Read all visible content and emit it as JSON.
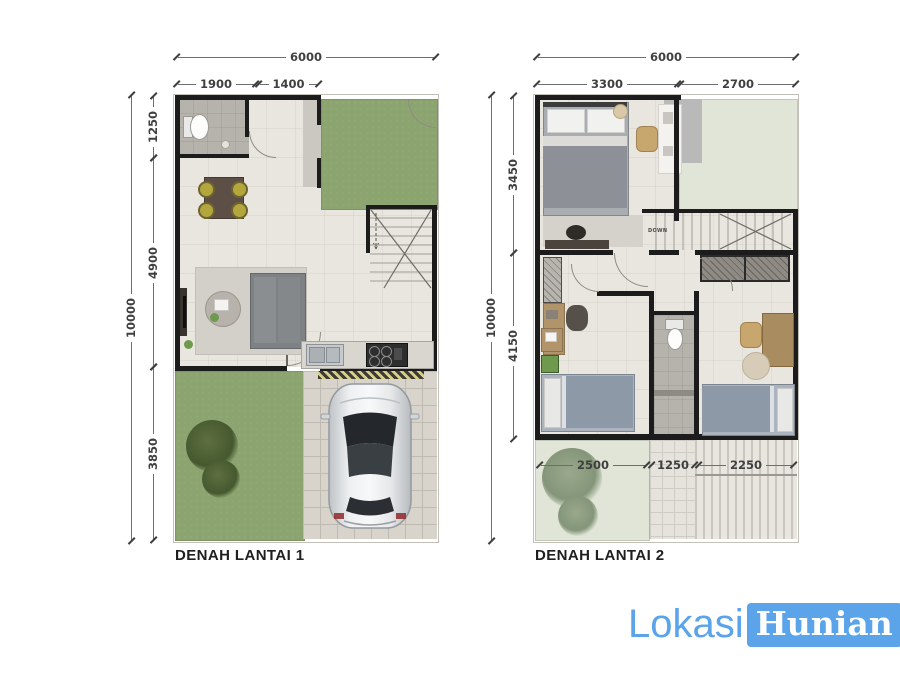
{
  "colors": {
    "wall": "#1c1c1c",
    "floor": "#e9e5df",
    "bath-floor": "#b6b2ac",
    "garden": "#8ca46f",
    "terrace": "#e0e5d7",
    "dim": "#3f3f3f",
    "label": "#1f1f1f",
    "site-border": "#c3bfb9",
    "logo-blue": "#5ba4ea"
  },
  "plan1": {
    "title": "DENAH LANTAI 1",
    "dims": {
      "width_total": "6000",
      "width_segments": [
        "1900",
        "1400"
      ],
      "height_total": "10000",
      "height_segments": [
        "1250",
        "4900",
        "3850"
      ]
    }
  },
  "plan2": {
    "title": "DENAH LANTAI 2",
    "dims": {
      "width_total": "6000",
      "width_segments": [
        "3300",
        "2700"
      ],
      "height_total": "10000",
      "height_segments": [
        "3450",
        "4150"
      ],
      "bottom_segments": [
        "2500",
        "1250",
        "2250"
      ]
    },
    "stairs_label": "DOWN"
  },
  "logo": {
    "text_light": "Lokasi",
    "text_boxed": "Hunian"
  },
  "icons": {
    "toilet": "css-ellipse-shape",
    "car": "inline-svg-top-view",
    "stairs": "inline-svg-treads",
    "bush": "radial-gradient-blob",
    "tree": "radial-gradient-blob"
  }
}
